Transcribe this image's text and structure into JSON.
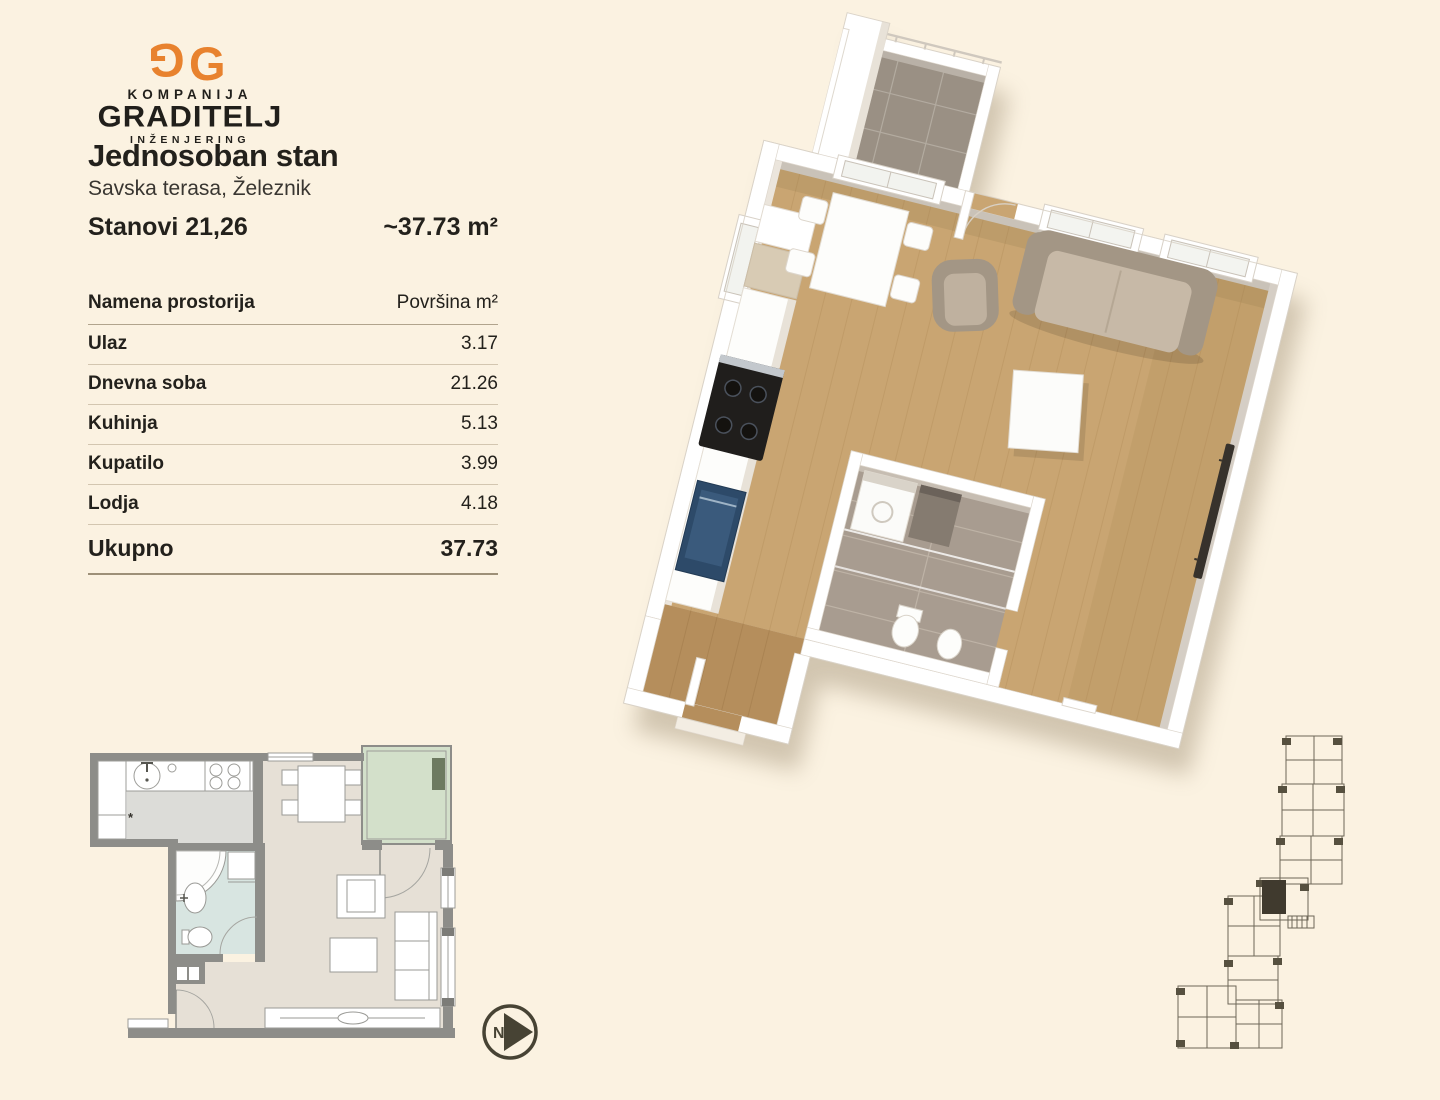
{
  "logo": {
    "monogram_left": "G",
    "monogram_right": "G",
    "line1": "KOMPANIJA",
    "line2": "GRADITELJ",
    "line3": "INŽENJERING"
  },
  "header": {
    "title": "Jednosoban stan",
    "subtitle": "Savska terasa, Železnik"
  },
  "summary": {
    "unit": "Stanovi 21,26",
    "area": "~37.73 m²"
  },
  "table": {
    "header": {
      "room": "Namena prostorija",
      "area": "Površina m²"
    },
    "rows": [
      {
        "label": "Ulaz",
        "value": "3.17"
      },
      {
        "label": "Dnevna soba",
        "value": "21.26"
      },
      {
        "label": "Kuhinja",
        "value": "5.13"
      },
      {
        "label": "Kupatilo",
        "value": "3.99"
      },
      {
        "label": "Lodja",
        "value": "4.18"
      }
    ],
    "total": {
      "label": "Ukupno",
      "value": "37.73"
    }
  },
  "compass": {
    "letter": "N"
  },
  "colors": {
    "background": "#fbf2e1",
    "accent_orange": "#e8822e",
    "text": "#23211c",
    "wood_floor": "#c9a572",
    "wall_white": "#ffffff",
    "loggia_tile_3d": "#9a9084",
    "bath_tile_3d": "#a89c90",
    "sofa": "#a39685",
    "plan2d_wall": "#8d8d89",
    "plan2d_living_floor": "#e6e0d6",
    "plan2d_kitchen_floor": "#dcdcd8",
    "plan2d_bath_floor": "#d8e5e1",
    "plan2d_loggia_floor": "#d3e0ca",
    "siteplan_line": "#6e6758",
    "siteplan_highlight": "#403a2e"
  }
}
